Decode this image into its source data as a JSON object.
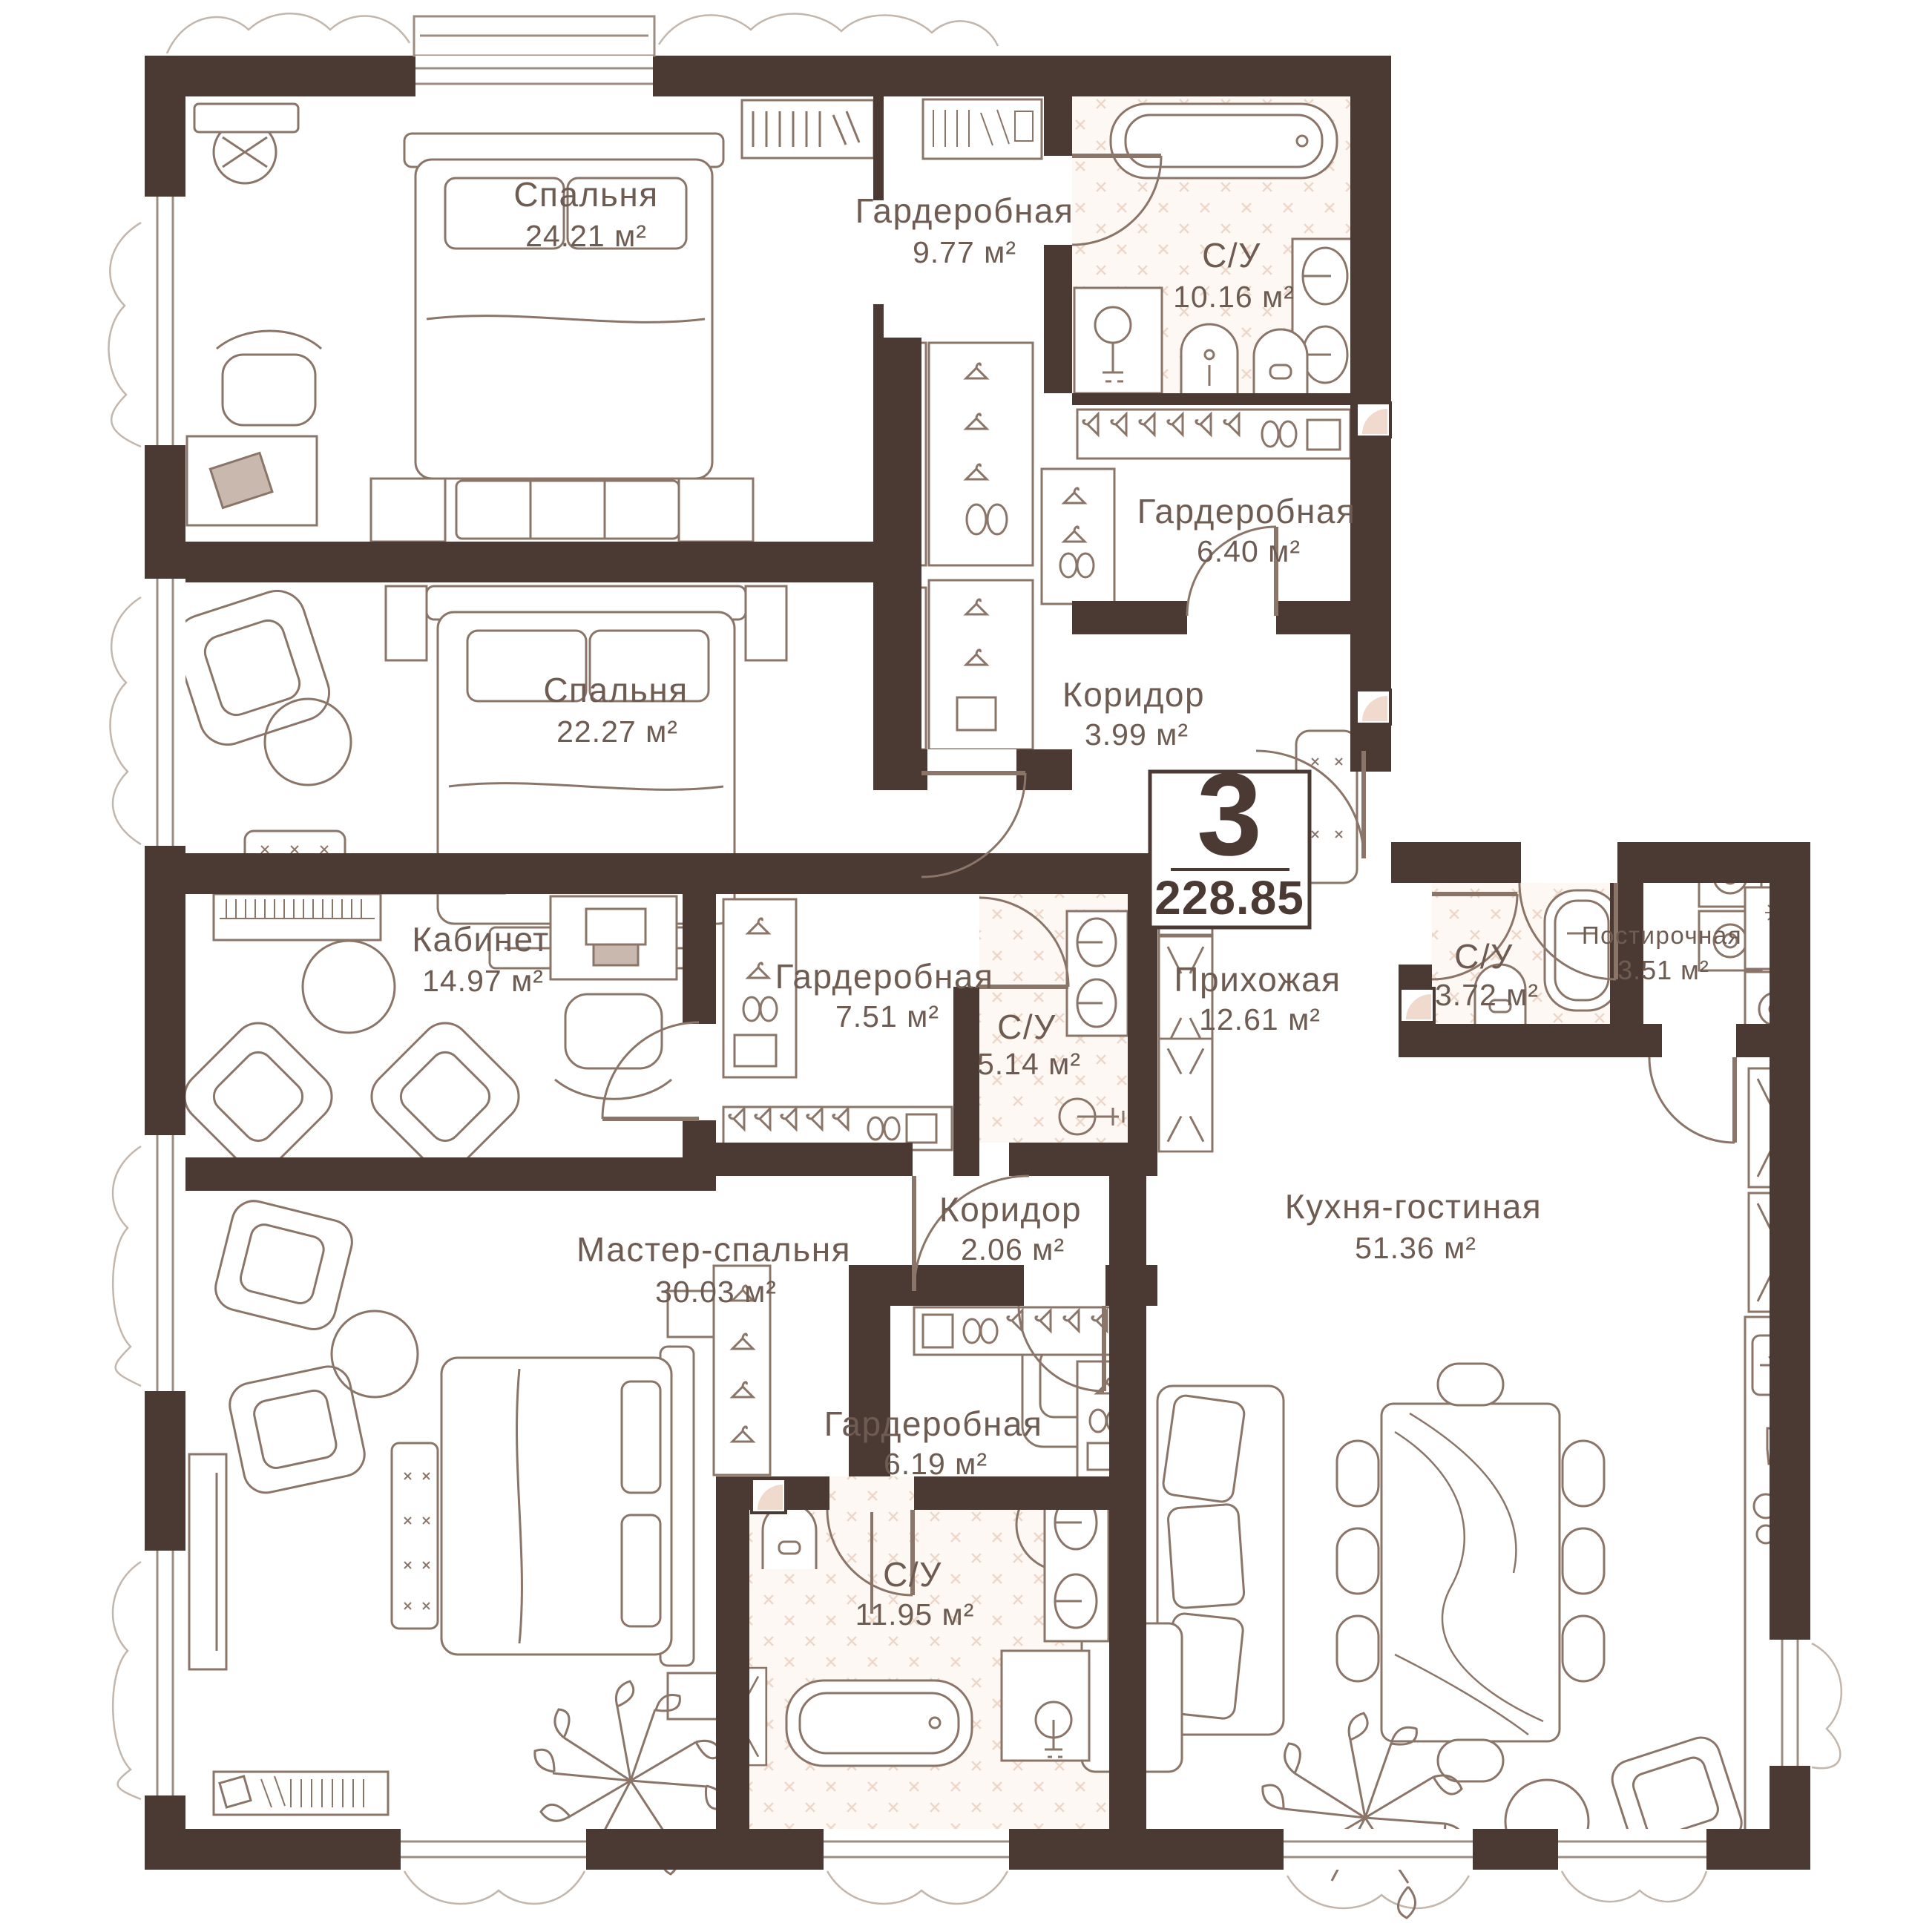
{
  "plan": {
    "badge": {
      "rooms_count": "3",
      "total_area": "228.85"
    },
    "rooms": [
      {
        "id": "bedroom-1",
        "name": "Спальня",
        "area": "24.21 м²"
      },
      {
        "id": "wardrobe-top",
        "name": "Гардеробная",
        "area": "9.77 м²"
      },
      {
        "id": "bathroom-main",
        "name": "С/У",
        "area": "10.16 м²"
      },
      {
        "id": "wardrobe-small",
        "name": "Гардеробная",
        "area": "6.40 м²"
      },
      {
        "id": "bedroom-2",
        "name": "Спальня",
        "area": "22.27 м²"
      },
      {
        "id": "corridor-top",
        "name": "Коридор",
        "area": "3.99 м²"
      },
      {
        "id": "study",
        "name": "Кабинет",
        "area": "14.97 м²"
      },
      {
        "id": "wardrobe-mid",
        "name": "Гардеробная",
        "area": "7.51 м²"
      },
      {
        "id": "bathroom-mid",
        "name": "С/У",
        "area": "5.14 м²"
      },
      {
        "id": "hallway",
        "name": "Прихожая",
        "area": "12.61 м²"
      },
      {
        "id": "bathroom-guest",
        "name": "С/У",
        "area": "3.72 м²"
      },
      {
        "id": "laundry",
        "name": "Постирочная",
        "area": "3.51 м²"
      },
      {
        "id": "master-bedroom",
        "name": "Мастер-спальня",
        "area": "30.03 м²"
      },
      {
        "id": "corridor-small",
        "name": "Коридор",
        "area": "2.06 м²"
      },
      {
        "id": "wardrobe-master",
        "name": "Гардеробная",
        "area": "6.19 м²"
      },
      {
        "id": "bathroom-master",
        "name": "С/У",
        "area": "11.95 м²"
      },
      {
        "id": "kitchen-living",
        "name": "Кухня-гостиная",
        "area": "51.36 м²"
      }
    ],
    "colors": {
      "wall": "#4b3a33",
      "furniture_line": "#8b7569",
      "label_text": "#6e5c53",
      "tile_bg": "#fdf8f4",
      "tile_line": "#eed7c9",
      "accent_pink": "#f0d9cd",
      "background": "#ffffff"
    }
  }
}
